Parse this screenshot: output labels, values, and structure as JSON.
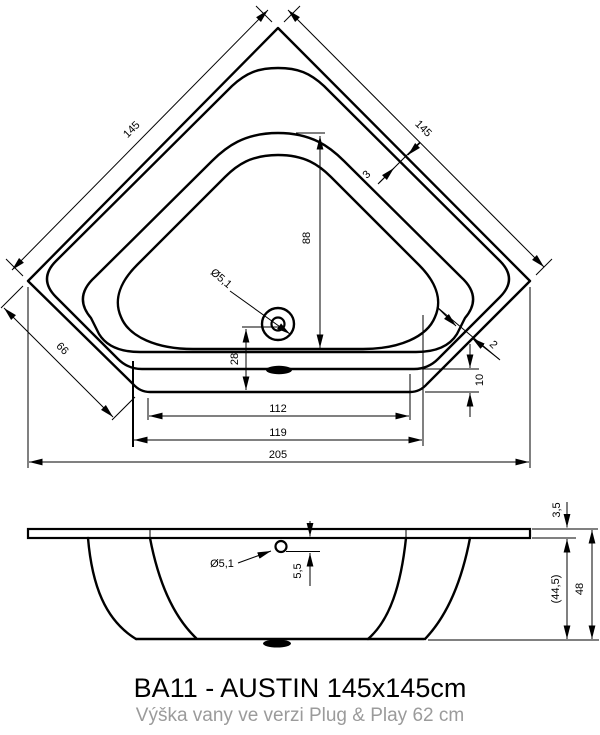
{
  "drawing": {
    "top_view": {
      "edge_left": "145",
      "edge_right": "145",
      "corner_cut": "66",
      "rim_width": "3",
      "inner_gap": "2",
      "front_rim": "10",
      "basin_length": "88",
      "drain_offset": "28",
      "width_inner": "112",
      "width_front": "119",
      "width_total": "205",
      "drain_diameter": "Ø5,1"
    },
    "side_view": {
      "rim_thickness": "3,5",
      "drain_depth": "5,5",
      "body_height": "(44,5)",
      "total_height": "48",
      "drain_diameter": "Ø5,1"
    },
    "footer": {
      "title": "BA11 - AUSTIN 145x145cm",
      "subtitle": "Výška vany ve verzi Plug & Play 62 cm"
    },
    "colors": {
      "line": "#000000",
      "subtitle_text": "#9b9b9b",
      "background": "#ffffff"
    }
  }
}
